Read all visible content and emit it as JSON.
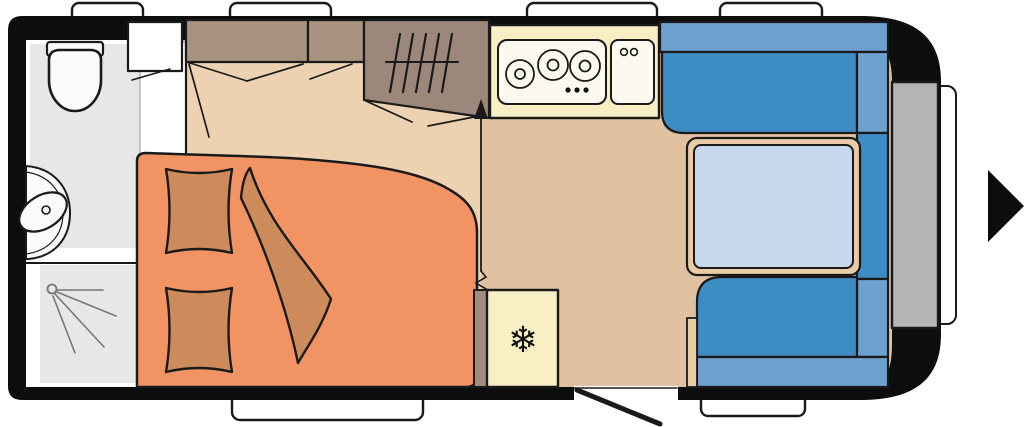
{
  "meta": {
    "type": "caravan-floor-plan",
    "view": "top-down",
    "direction_of_travel": "right"
  },
  "symbols": {
    "snowflake": "❄"
  },
  "colors": {
    "wall": "#0d0d0d",
    "outline": "#1a1a1a",
    "window": "#ffffff",
    "floor_bedroom": "#edd2b1",
    "floor_living": "#e0c2a1",
    "bathroom": "#e7e7e7",
    "fixture_white": "#fafafa",
    "bed": "#f29364",
    "bedding": "#cd8b5b",
    "cabinet": "#a8937f",
    "wardrobe": "#9c887a",
    "partition": "#a08b7e",
    "kitchen": "#f7eec3",
    "appliance": "#fcf9ee",
    "fridge": "#f8efc5",
    "seat": "#3e8cc4",
    "backrest": "#6fa1d0",
    "table_frame": "#e7cca6",
    "table_top": "#c6d9ed",
    "front_box": "#b5b5b5"
  },
  "rooms": {
    "bathroom": {
      "fixtures": [
        "toilet",
        "washbasin",
        "shower",
        "bathroom-cabinet"
      ]
    },
    "bedroom": {
      "fixtures": [
        "french-bed",
        "pillow",
        "pillow",
        "duvet",
        "overhead-locker",
        "overhead-locker",
        "wardrobe"
      ]
    },
    "kitchen": {
      "fixtures": [
        "hob-3-burner",
        "kitchen-sink",
        "fridge"
      ]
    },
    "dinette": {
      "fixtures": [
        "bench-seat-top",
        "bench-seat-bottom",
        "side-cushion",
        "dinette-table"
      ]
    },
    "exterior": {
      "fixtures": [
        "window",
        "window",
        "window",
        "window",
        "window",
        "window",
        "drawbar-box",
        "hitch-cover",
        "entrance-door",
        "direction-arrow"
      ]
    }
  }
}
